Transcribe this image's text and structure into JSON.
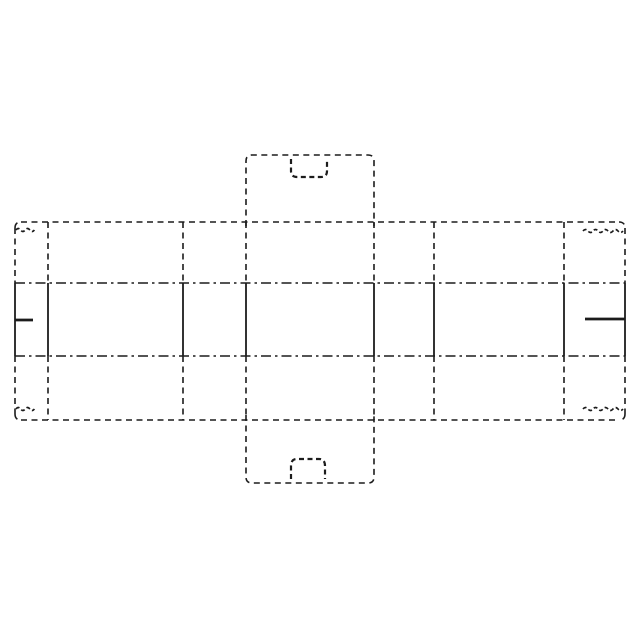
{
  "figure": {
    "kind": "carton-blank-flat-pattern-drawing",
    "background_color": "#ffffff",
    "line_color": "#1c1c1c",
    "canvas": {
      "width": 640,
      "height": 640
    },
    "styles": {
      "dashed": {
        "dash": "6 4.5",
        "width": 1.6
      },
      "dashdot": {
        "dash": "10 4 2.5 4",
        "width": 1.6
      },
      "solid": {
        "dash": "",
        "width": 1.8
      },
      "bold": {
        "dash": "",
        "width": 2.8
      },
      "handle": {
        "dash": "5 3.5",
        "width": 2.2
      },
      "wavy": {
        "dash": "4 2.5",
        "width": 1.7
      }
    },
    "shapes": [
      {
        "name": "band-top-edge",
        "type": "line",
        "style": "dashed",
        "x1": 21,
        "y1": 222,
        "x2": 619,
        "y2": 222
      },
      {
        "name": "band-bottom-edge",
        "type": "line",
        "style": "dashed",
        "x1": 21,
        "y1": 420,
        "x2": 619,
        "y2": 420
      },
      {
        "name": "left-edge-top",
        "type": "line",
        "style": "dashed",
        "x1": 15,
        "y1": 228,
        "x2": 15,
        "y2": 283
      },
      {
        "name": "left-edge-cut",
        "type": "line",
        "style": "solid",
        "x1": 15,
        "y1": 283,
        "x2": 15,
        "y2": 356
      },
      {
        "name": "left-edge-bottom",
        "type": "line",
        "style": "dashed",
        "x1": 15,
        "y1": 356,
        "x2": 15,
        "y2": 414
      },
      {
        "name": "right-edge-top",
        "type": "line",
        "style": "dashed",
        "x1": 625,
        "y1": 228,
        "x2": 625,
        "y2": 283
      },
      {
        "name": "right-edge-cut",
        "type": "line",
        "style": "solid",
        "x1": 625,
        "y1": 283,
        "x2": 625,
        "y2": 356
      },
      {
        "name": "right-edge-bottom",
        "type": "line",
        "style": "dashed",
        "x1": 625,
        "y1": 356,
        "x2": 625,
        "y2": 414
      },
      {
        "name": "corner-arc-top-left",
        "type": "path",
        "style": "dashed",
        "d": "M15,228 Q15,222 21,222"
      },
      {
        "name": "corner-arc-top-right",
        "type": "path",
        "style": "dashed",
        "d": "M619,222 Q625,222 625,228"
      },
      {
        "name": "corner-arc-bottom-left",
        "type": "path",
        "style": "dashed",
        "d": "M15,414 Q15,420 21,420"
      },
      {
        "name": "corner-arc-bottom-right",
        "type": "path",
        "style": "dashed",
        "d": "M625,414 Q625,420 619,420"
      },
      {
        "name": "fold-line-upper",
        "type": "line",
        "style": "dashdot",
        "x1": 15,
        "y1": 283,
        "x2": 625,
        "y2": 283
      },
      {
        "name": "fold-line-lower",
        "type": "line",
        "style": "dashdot",
        "x1": 15,
        "y1": 356,
        "x2": 625,
        "y2": 356
      },
      {
        "name": "crease-top-1",
        "type": "line",
        "style": "dashed",
        "x1": 48,
        "y1": 222,
        "x2": 48,
        "y2": 283
      },
      {
        "name": "cut-mid-1",
        "type": "line",
        "style": "solid",
        "x1": 48,
        "y1": 283,
        "x2": 48,
        "y2": 356
      },
      {
        "name": "crease-bot-1",
        "type": "line",
        "style": "dashed",
        "x1": 48,
        "y1": 356,
        "x2": 48,
        "y2": 420
      },
      {
        "name": "crease-top-2",
        "type": "line",
        "style": "dashed",
        "x1": 183,
        "y1": 222,
        "x2": 183,
        "y2": 283
      },
      {
        "name": "cut-mid-2",
        "type": "line",
        "style": "solid",
        "x1": 183,
        "y1": 283,
        "x2": 183,
        "y2": 356
      },
      {
        "name": "crease-bot-2",
        "type": "line",
        "style": "dashed",
        "x1": 183,
        "y1": 356,
        "x2": 183,
        "y2": 420
      },
      {
        "name": "crease-top-3",
        "type": "line",
        "style": "dashed",
        "x1": 246,
        "y1": 222,
        "x2": 246,
        "y2": 283
      },
      {
        "name": "cut-mid-3",
        "type": "line",
        "style": "solid",
        "x1": 246,
        "y1": 283,
        "x2": 246,
        "y2": 356
      },
      {
        "name": "crease-bot-3",
        "type": "line",
        "style": "dashed",
        "x1": 246,
        "y1": 356,
        "x2": 246,
        "y2": 420
      },
      {
        "name": "crease-top-4",
        "type": "line",
        "style": "dashed",
        "x1": 374,
        "y1": 222,
        "x2": 374,
        "y2": 283
      },
      {
        "name": "cut-mid-4",
        "type": "line",
        "style": "solid",
        "x1": 374,
        "y1": 283,
        "x2": 374,
        "y2": 356
      },
      {
        "name": "crease-bot-4",
        "type": "line",
        "style": "dashed",
        "x1": 374,
        "y1": 356,
        "x2": 374,
        "y2": 420
      },
      {
        "name": "crease-top-5",
        "type": "line",
        "style": "dashed",
        "x1": 434,
        "y1": 222,
        "x2": 434,
        "y2": 283
      },
      {
        "name": "cut-mid-5",
        "type": "line",
        "style": "solid",
        "x1": 434,
        "y1": 283,
        "x2": 434,
        "y2": 356
      },
      {
        "name": "crease-bot-5",
        "type": "line",
        "style": "dashed",
        "x1": 434,
        "y1": 356,
        "x2": 434,
        "y2": 420
      },
      {
        "name": "crease-top-6",
        "type": "line",
        "style": "dashed",
        "x1": 564,
        "y1": 222,
        "x2": 564,
        "y2": 283
      },
      {
        "name": "cut-mid-6",
        "type": "line",
        "style": "solid",
        "x1": 564,
        "y1": 283,
        "x2": 564,
        "y2": 356
      },
      {
        "name": "crease-bot-6",
        "type": "line",
        "style": "dashed",
        "x1": 564,
        "y1": 356,
        "x2": 564,
        "y2": 420
      },
      {
        "name": "left-slit-cut",
        "type": "line",
        "style": "bold",
        "x1": 15,
        "y1": 320,
        "x2": 33,
        "y2": 320
      },
      {
        "name": "right-slit-cut",
        "type": "line",
        "style": "bold",
        "x1": 585,
        "y1": 319,
        "x2": 625,
        "y2": 319
      },
      {
        "name": "top-tab-outline",
        "type": "path",
        "style": "dashed",
        "d": "M246,226 L246,161 Q246,155 252,155 L368,155 Q374,155 374,161 L374,226"
      },
      {
        "name": "bottom-tab-outline",
        "type": "path",
        "style": "dashed",
        "d": "M246,415 L246,477 Q246,483 252,483 L368,483 Q374,483 374,477 L374,415"
      },
      {
        "name": "top-handle-cutout",
        "type": "path",
        "style": "handle",
        "d": "M291,159 L291,171 Q291,177 297,177 L321,177 Q327,177 327,171 L327,159"
      },
      {
        "name": "bottom-handle-cutout",
        "type": "path",
        "style": "handle",
        "d": "M291,479 L291,466 Q291,459 297,459 L319,459 Q325,459 325,466 L325,479"
      },
      {
        "name": "serration-top-left",
        "type": "path",
        "style": "wavy",
        "d": "M16,230 q2.3,-3 4.6,0 t4.6,0 t4.6,0 t4.6,0"
      },
      {
        "name": "serration-bottom-left",
        "type": "path",
        "style": "wavy",
        "d": "M16,409 q2.3,-3 4.6,0 t4.6,0 t4.6,0 t4.6,0"
      },
      {
        "name": "serration-top-right",
        "type": "path",
        "style": "wavy",
        "d": "M583,231 q2.5,-3 5,0 t5,0 t5,0 t5,0 t5,0 t5,0 t5,0 t5,0"
      },
      {
        "name": "serration-bottom-right",
        "type": "path",
        "style": "wavy",
        "d": "M583,409 q2.5,-3 5,0 t5,0 t5,0 t5,0 t5,0 t5,0 t5,0 t5,0"
      }
    ]
  }
}
